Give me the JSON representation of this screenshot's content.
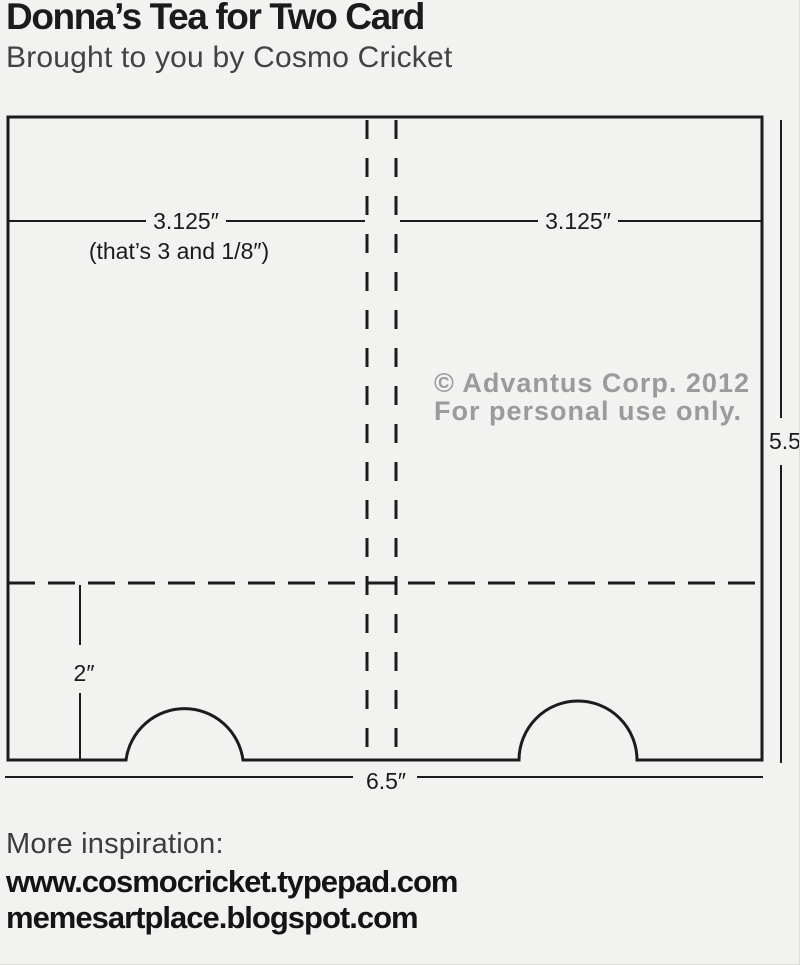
{
  "header": {
    "title": "Donna’s Tea for Two Card",
    "subtitle": "Brought to you by Cosmo Cricket"
  },
  "diagram": {
    "type": "card-cutting-template",
    "dim_left_width": "3.125″",
    "dim_left_note": "(that’s 3 and 1/8″)",
    "dim_right_width": "3.125″",
    "dim_height": "5.5″",
    "dim_flap": "2″",
    "dim_total_width": "6.5″",
    "copyright_line1": "© Advantus Corp. 2012",
    "copyright_line2": "For personal use only.",
    "colors": {
      "line": "#1c1c1c",
      "copyright": "#9b9b9b",
      "background": "#f2f2f1"
    }
  },
  "footer": {
    "more_label": "More inspiration:",
    "link1": "www.cosmocricket.typepad.com",
    "link2": "memesartplace.blogspot.com"
  }
}
